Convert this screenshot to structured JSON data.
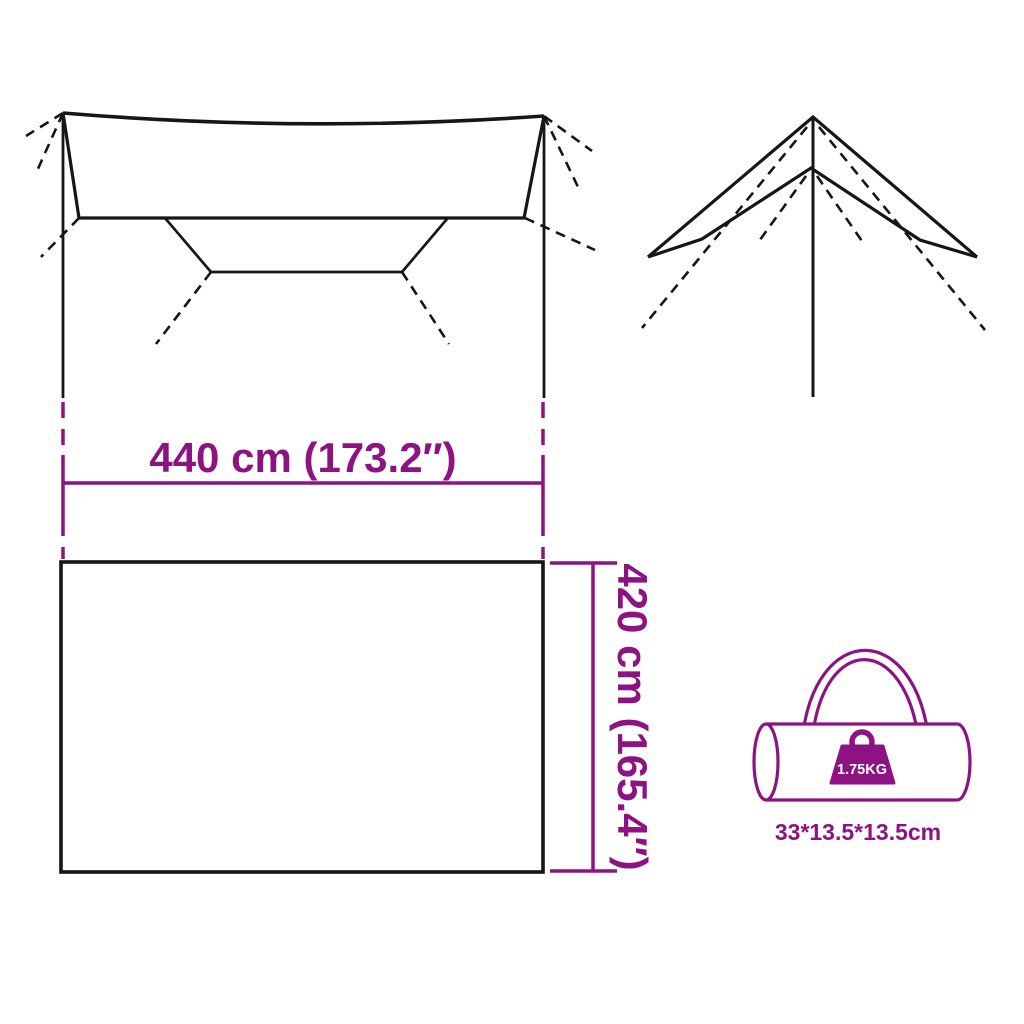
{
  "colors": {
    "accent": "#8D1282",
    "line": "#161616",
    "background": "#FFFFFF"
  },
  "dimensions": {
    "width": {
      "label": "440 cm (173.2″)"
    },
    "depth": {
      "label": "420 cm (165.4″)"
    }
  },
  "bag": {
    "weight": "1.75KG",
    "size": "33*13.5*13.5cm"
  }
}
